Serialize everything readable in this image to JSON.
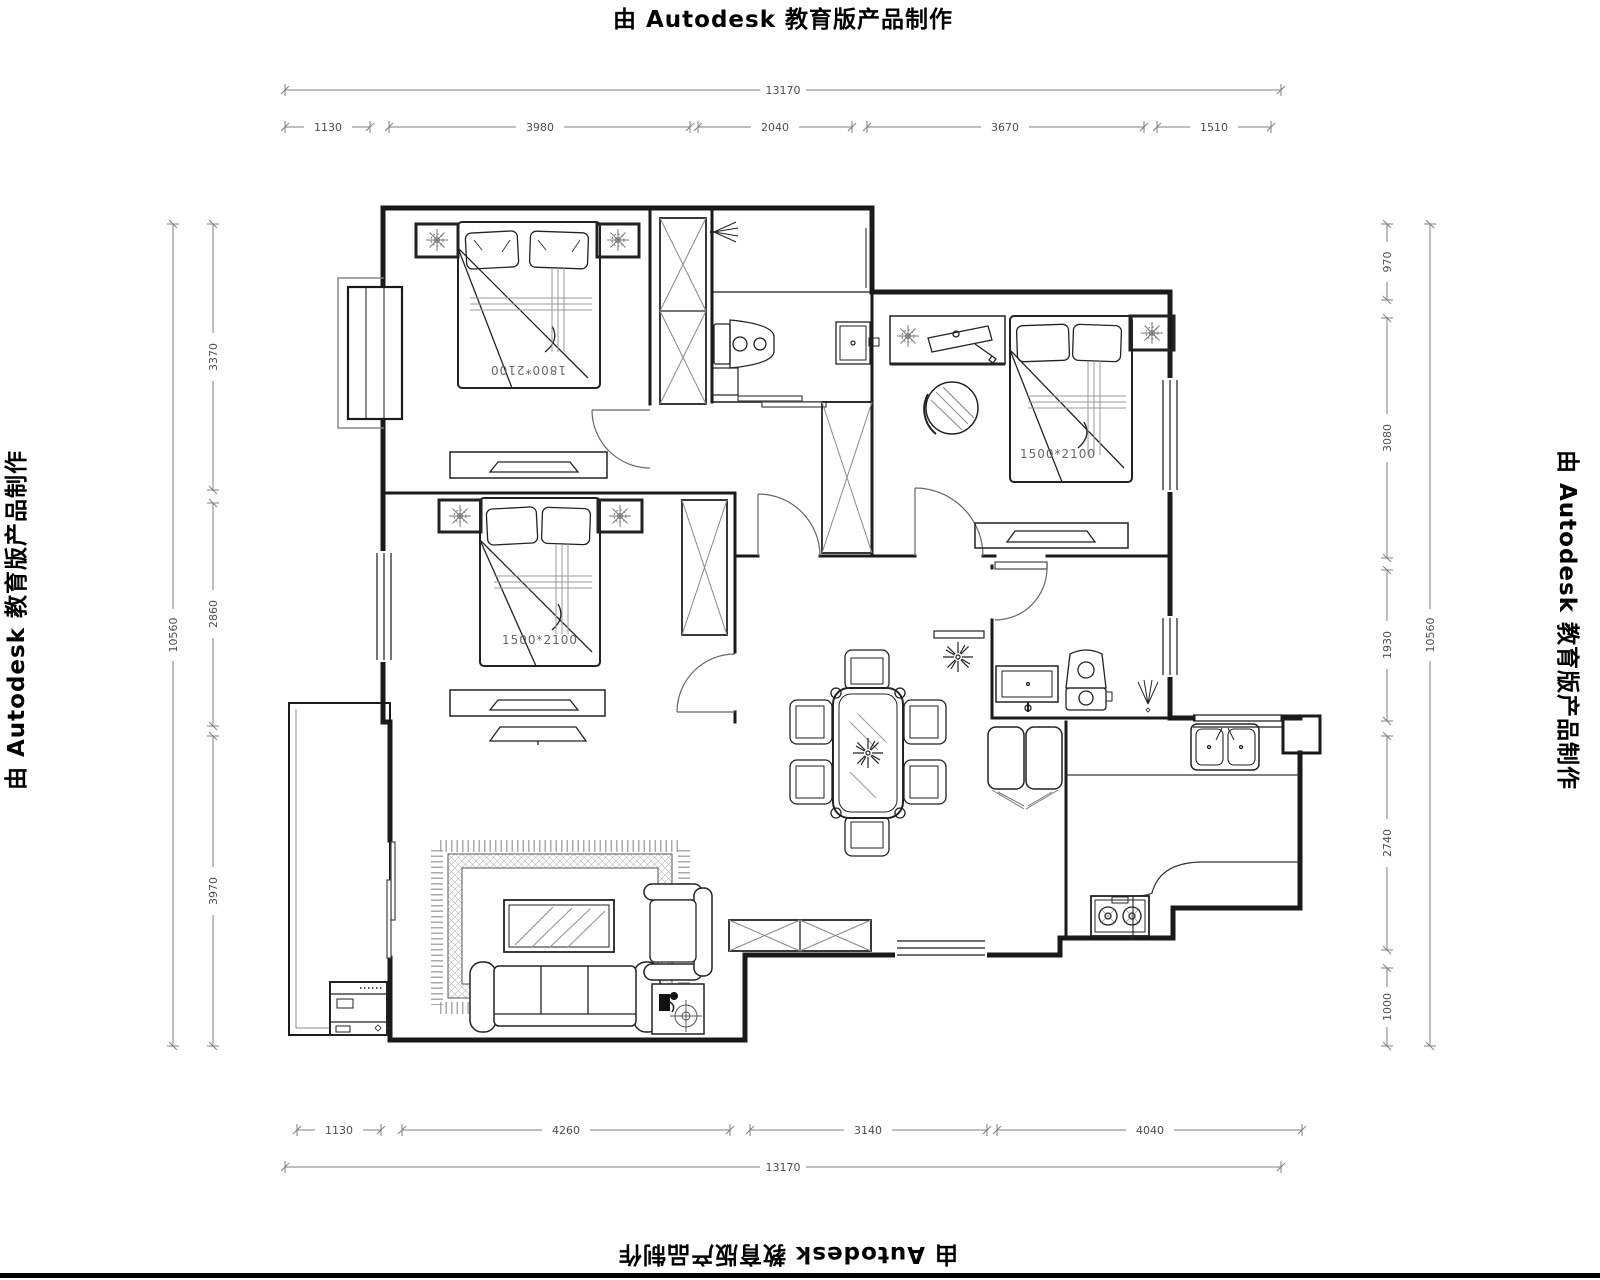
{
  "edition_notice": {
    "top": "由 Autodesk 教育版产品制作",
    "bottom": "由 Autodesk 教育版产品制作",
    "left": "由 Autodesk 教育版产品制作",
    "right": "由 Autodesk 教育版产品制作"
  },
  "dimensions": {
    "top": {
      "overall": "13170",
      "segments": [
        "1130",
        "3980",
        "2040",
        "3670",
        "1510"
      ]
    },
    "bottom": {
      "overall": "13170",
      "segments": [
        "1130",
        "4260",
        "3140",
        "4040"
      ]
    },
    "left": {
      "overall": "10560",
      "segments": [
        "3370",
        "2860",
        "3970"
      ]
    },
    "right": {
      "overall": "10560",
      "segments": [
        "970",
        "3080",
        "1930",
        "2740",
        "1000"
      ]
    }
  },
  "labels": {
    "bed_master": "1800*2100",
    "bed_second": "1500*2100",
    "bed_third": "1500*2100"
  },
  "colors": {
    "wall": "#1a1a1a",
    "dimension": "#7f7f7f",
    "dim_text": "#4d4d4d",
    "furniture": "#222222",
    "hatch": "#999999",
    "background": "#ffffff"
  }
}
